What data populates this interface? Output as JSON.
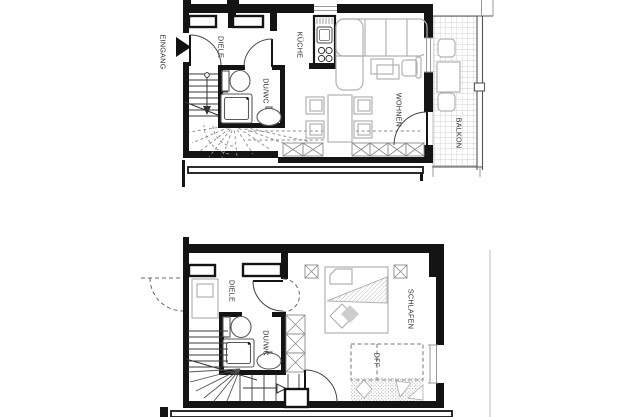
{
  "document": {
    "kind": "apartment floor plan, two levels"
  },
  "colors": {
    "background": "#ffffff",
    "walls": "#141414",
    "furniture_outline": "#b2b2b2",
    "hatch_gray": "#c4c4c4"
  },
  "upper_floor": {
    "labels": {
      "eingang": "EINGANG",
      "diele": "DIELE",
      "du_wc": "DU/WC",
      "kueche": "KÜCHE",
      "wohnen": "WOHNEN",
      "balkon": "BALKON"
    }
  },
  "lower_floor": {
    "labels": {
      "diele": "DIELE",
      "du_wc": "DU/WC",
      "schlafen": "SCHLAFEN",
      "dff": "DFF"
    }
  }
}
